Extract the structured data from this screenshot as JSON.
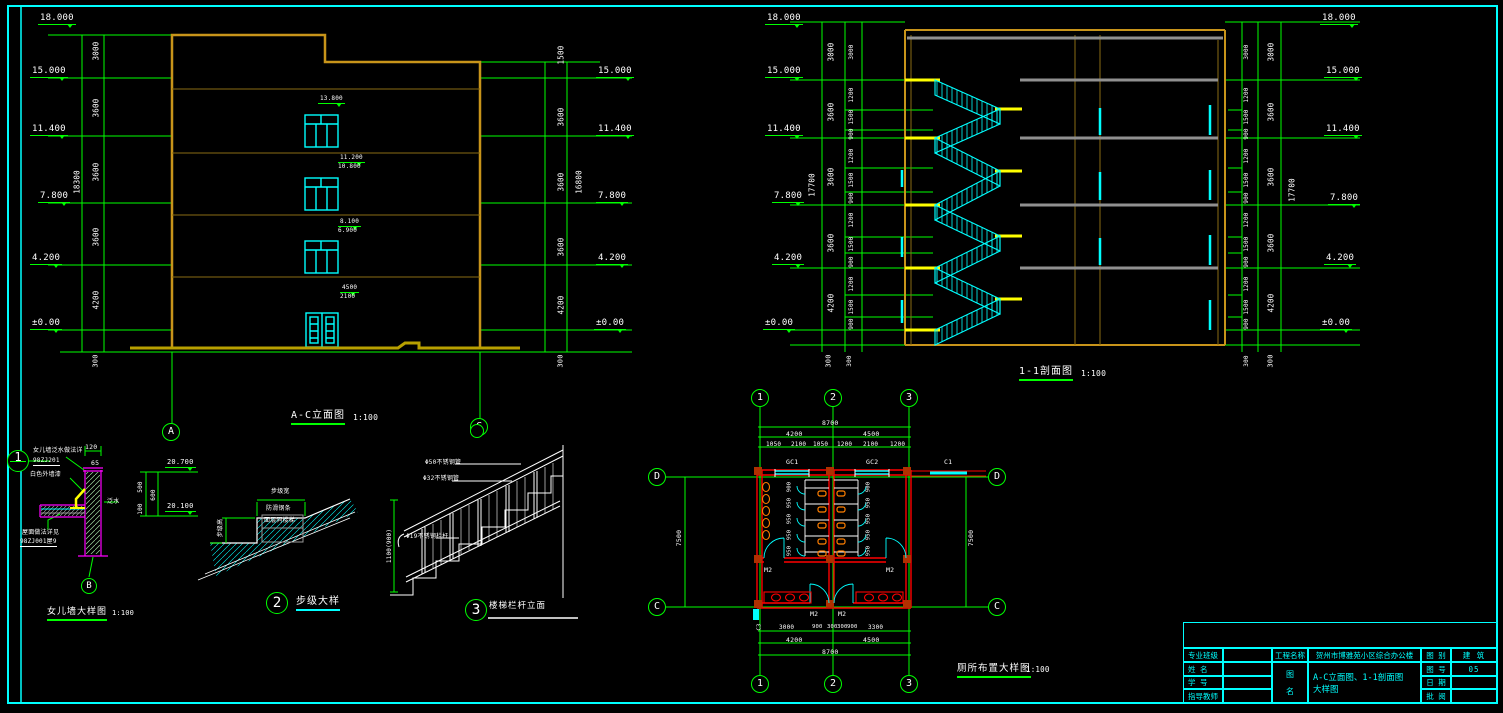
{
  "sheet": {
    "background": "#000000",
    "frame_color": "#00ffff"
  },
  "colors": {
    "dim_green": "#00ff00",
    "text_white": "#ffffff",
    "window_cyan": "#00ffff",
    "wall_orange": "#c8941a",
    "floor_brown": "#8a6d14",
    "ground_yellow": "#b8a000",
    "landing_yellow": "#ffff00",
    "parapet_magenta": "#ff00ff",
    "plan_wall_red": "#ff0000",
    "fixture_orange": "#ff7f00",
    "slab_gray": "#909090"
  },
  "drawings": {
    "elevation": {
      "title": "A-C立面图",
      "scale": "1:100",
      "x": 291,
      "y": 411,
      "u": "g",
      "fs": 10,
      "sx": 353,
      "sy": 414
    },
    "section": {
      "title": "1-1剖面图",
      "scale": "1:100",
      "x": 1019,
      "y": 367,
      "u": "g",
      "fs": 10,
      "sx": 1081,
      "sy": 370
    },
    "parapet": {
      "title": "女儿墙大样图",
      "scale": "1:100",
      "x": 47,
      "y": 608,
      "u": "g",
      "fs": 9,
      "sx": 112,
      "sy": 610
    },
    "step": {
      "title": "步级大样",
      "scale": "",
      "x": 296,
      "y": 597,
      "u": "c",
      "fs": 10,
      "sx": 0,
      "sy": 0
    },
    "railing": {
      "title": "楼梯栏杆立面",
      "scale": "",
      "x": 489,
      "y": 602,
      "u": "",
      "fs": 8.5,
      "sx": 0,
      "sy": 0
    },
    "toilet": {
      "title": "厕所布置大样图",
      "scale": "1:100",
      "x": 957,
      "y": 664,
      "u": "g",
      "fs": 9.5,
      "sx": 1026,
      "sy": 666
    }
  },
  "title_block": {
    "col_left": [
      {
        "label": "专业班级",
        "value": ""
      },
      {
        "label": "姓  名",
        "value": ""
      },
      {
        "label": "学  号",
        "value": ""
      },
      {
        "label": "指导教师",
        "value": ""
      }
    ],
    "project": {
      "label": "工程名称",
      "value": "贺州市博雅苑小区综合办公楼"
    },
    "drawing": {
      "label1": "图",
      "label2": "名",
      "line1": "A-C立面图、1-1剖面图",
      "line2": "大样图"
    },
    "col_right": [
      {
        "label": "图 别",
        "value": "建 筑"
      },
      {
        "label": "图 号",
        "value": "05"
      },
      {
        "label": "日 期",
        "value": ""
      },
      {
        "label": "批 阅",
        "value": ""
      }
    ]
  },
  "axis_bubbles": [
    {
      "t": "A",
      "x": 171,
      "y": 432,
      "r": 9
    },
    {
      "t": "C",
      "x": 479,
      "y": 427,
      "r": 9
    },
    {
      "t": "1",
      "x": 760,
      "y": 398,
      "r": 9
    },
    {
      "t": "2",
      "x": 833,
      "y": 398,
      "r": 9
    },
    {
      "t": "3",
      "x": 909,
      "y": 398,
      "r": 9
    },
    {
      "t": "1",
      "x": 760,
      "y": 684,
      "r": 9
    },
    {
      "t": "2",
      "x": 833,
      "y": 684,
      "r": 9
    },
    {
      "t": "3",
      "x": 909,
      "y": 684,
      "r": 9
    },
    {
      "t": "D",
      "x": 657,
      "y": 477,
      "r": 9
    },
    {
      "t": "D",
      "x": 997,
      "y": 477,
      "r": 9
    },
    {
      "t": "C",
      "x": 657,
      "y": 607,
      "r": 9
    },
    {
      "t": "C",
      "x": 997,
      "y": 607,
      "r": 9
    },
    {
      "t": "B",
      "x": 89,
      "y": 586,
      "r": 8
    },
    {
      "t": "1",
      "x": 18,
      "y": 461,
      "r": 11,
      "split": 1
    },
    {
      "t": "2",
      "x": 277,
      "y": 603,
      "r": 11,
      "d": 1
    },
    {
      "t": "3",
      "x": 476,
      "y": 610,
      "r": 11,
      "d": 1
    },
    {
      "t": "",
      "x": 477,
      "y": 431,
      "r": 7
    }
  ],
  "labels": [
    {
      "t": "18.000",
      "x": 38,
      "y": 14,
      "lvl": 1,
      "fs": 9
    },
    {
      "t": "15.000",
      "x": 30,
      "y": 67,
      "lvl": 1,
      "fs": 9
    },
    {
      "t": "11.400",
      "x": 30,
      "y": 125,
      "lvl": 1,
      "fs": 9
    },
    {
      "t": "7.800",
      "x": 38,
      "y": 192,
      "lvl": 1,
      "fs": 9
    },
    {
      "t": "4.200",
      "x": 30,
      "y": 254,
      "lvl": 1,
      "fs": 9
    },
    {
      "t": "±0.00",
      "x": 30,
      "y": 319,
      "lvl": 1,
      "fs": 9
    },
    {
      "t": "3000",
      "x": 96,
      "y": 51,
      "r": 1
    },
    {
      "t": "3600",
      "x": 96,
      "y": 108,
      "r": 1
    },
    {
      "t": "3600",
      "x": 96,
      "y": 172,
      "r": 1
    },
    {
      "t": "18300",
      "x": 77,
      "y": 182,
      "r": 1
    },
    {
      "t": "3600",
      "x": 96,
      "y": 237,
      "r": 1
    },
    {
      "t": "4200",
      "x": 96,
      "y": 300,
      "r": 1
    },
    {
      "t": "300",
      "x": 96,
      "y": 361,
      "r": 1,
      "fs": 7
    },
    {
      "t": "1500",
      "x": 561,
      "y": 55,
      "r": 1
    },
    {
      "t": "15.000",
      "x": 596,
      "y": 67,
      "lvl": 1,
      "fs": 9
    },
    {
      "t": "3600",
      "x": 561,
      "y": 117,
      "r": 1
    },
    {
      "t": "11.400",
      "x": 596,
      "y": 125,
      "lvl": 1,
      "fs": 9
    },
    {
      "t": "3600",
      "x": 561,
      "y": 182,
      "r": 1
    },
    {
      "t": "16800",
      "x": 579,
      "y": 182,
      "r": 1
    },
    {
      "t": "7.800",
      "x": 596,
      "y": 192,
      "lvl": 1,
      "fs": 9
    },
    {
      "t": "3600",
      "x": 561,
      "y": 247,
      "r": 1
    },
    {
      "t": "4.200",
      "x": 596,
      "y": 254,
      "lvl": 1,
      "fs": 9
    },
    {
      "t": "4200",
      "x": 561,
      "y": 305,
      "r": 1
    },
    {
      "t": "±0.00",
      "x": 594,
      "y": 319,
      "lvl": 1,
      "fs": 9
    },
    {
      "t": "300",
      "x": 561,
      "y": 361,
      "r": 1,
      "fs": 7
    },
    {
      "t": "13.800",
      "x": 318,
      "y": 96,
      "lvl": 1,
      "fs": 6
    },
    {
      "t": "11.200",
      "x": 338,
      "y": 155,
      "lvl": 1,
      "fs": 6
    },
    {
      "t": "10.800",
      "x": 338,
      "y": 164,
      "fs": 6
    },
    {
      "t": "8.100",
      "x": 338,
      "y": 219,
      "lvl": 1,
      "fs": 6
    },
    {
      "t": "6.900",
      "x": 338,
      "y": 228,
      "fs": 6
    },
    {
      "t": "4500",
      "x": 340,
      "y": 285,
      "lvl": 1,
      "fs": 6
    },
    {
      "t": "2100",
      "x": 340,
      "y": 294,
      "fs": 6
    },
    {
      "t": "18.000",
      "x": 765,
      "y": 14,
      "lvl": 1,
      "fs": 9
    },
    {
      "t": "15.000",
      "x": 765,
      "y": 67,
      "lvl": 1,
      "fs": 9
    },
    {
      "t": "11.400",
      "x": 765,
      "y": 125,
      "lvl": 1,
      "fs": 9
    },
    {
      "t": "7.800",
      "x": 772,
      "y": 192,
      "lvl": 1,
      "fs": 9
    },
    {
      "t": "4.200",
      "x": 772,
      "y": 254,
      "lvl": 1,
      "fs": 9
    },
    {
      "t": "±0.00",
      "x": 763,
      "y": 319,
      "lvl": 1,
      "fs": 9
    },
    {
      "t": "3000",
      "x": 831,
      "y": 52,
      "r": 1
    },
    {
      "t": "3600",
      "x": 831,
      "y": 112,
      "r": 1
    },
    {
      "t": "3600",
      "x": 831,
      "y": 177,
      "r": 1
    },
    {
      "t": "17700",
      "x": 812,
      "y": 185,
      "r": 1
    },
    {
      "t": "3600",
      "x": 831,
      "y": 243,
      "r": 1
    },
    {
      "t": "4200",
      "x": 831,
      "y": 303,
      "r": 1
    },
    {
      "t": "300",
      "x": 829,
      "y": 361,
      "r": 1,
      "fs": 7
    },
    {
      "t": "3000",
      "x": 852,
      "y": 52,
      "r": 1,
      "fs": 6
    },
    {
      "t": "1200",
      "x": 852,
      "y": 95,
      "r": 1,
      "fs": 6
    },
    {
      "t": "1500",
      "x": 852,
      "y": 117,
      "r": 1,
      "fs": 6
    },
    {
      "t": "900",
      "x": 852,
      "y": 134,
      "r": 1,
      "fs": 6
    },
    {
      "t": "1200",
      "x": 852,
      "y": 156,
      "r": 1,
      "fs": 6
    },
    {
      "t": "1500",
      "x": 852,
      "y": 180,
      "r": 1,
      "fs": 6
    },
    {
      "t": "900",
      "x": 852,
      "y": 198,
      "r": 1,
      "fs": 6
    },
    {
      "t": "1200",
      "x": 852,
      "y": 220,
      "r": 1,
      "fs": 6
    },
    {
      "t": "1500",
      "x": 852,
      "y": 244,
      "r": 1,
      "fs": 6
    },
    {
      "t": "900",
      "x": 852,
      "y": 262,
      "r": 1,
      "fs": 6
    },
    {
      "t": "1200",
      "x": 852,
      "y": 284,
      "r": 1,
      "fs": 6
    },
    {
      "t": "1500",
      "x": 852,
      "y": 307,
      "r": 1,
      "fs": 6
    },
    {
      "t": "900",
      "x": 852,
      "y": 324,
      "r": 1,
      "fs": 6
    },
    {
      "t": "300",
      "x": 850,
      "y": 361,
      "r": 1,
      "fs": 6
    },
    {
      "t": "3000",
      "x": 1247,
      "y": 52,
      "r": 1,
      "fs": 6
    },
    {
      "t": "1200",
      "x": 1247,
      "y": 95,
      "r": 1,
      "fs": 6
    },
    {
      "t": "1500",
      "x": 1247,
      "y": 117,
      "r": 1,
      "fs": 6
    },
    {
      "t": "900",
      "x": 1247,
      "y": 134,
      "r": 1,
      "fs": 6
    },
    {
      "t": "1200",
      "x": 1247,
      "y": 156,
      "r": 1,
      "fs": 6
    },
    {
      "t": "1500",
      "x": 1247,
      "y": 180,
      "r": 1,
      "fs": 6
    },
    {
      "t": "900",
      "x": 1247,
      "y": 198,
      "r": 1,
      "fs": 6
    },
    {
      "t": "1200",
      "x": 1247,
      "y": 220,
      "r": 1,
      "fs": 6
    },
    {
      "t": "1500",
      "x": 1247,
      "y": 244,
      "r": 1,
      "fs": 6
    },
    {
      "t": "900",
      "x": 1247,
      "y": 262,
      "r": 1,
      "fs": 6
    },
    {
      "t": "1200",
      "x": 1247,
      "y": 284,
      "r": 1,
      "fs": 6
    },
    {
      "t": "1500",
      "x": 1247,
      "y": 307,
      "r": 1,
      "fs": 6
    },
    {
      "t": "900",
      "x": 1247,
      "y": 324,
      "r": 1,
      "fs": 6
    },
    {
      "t": "300",
      "x": 1247,
      "y": 361,
      "r": 1,
      "fs": 6
    },
    {
      "t": "3000",
      "x": 1271,
      "y": 52,
      "r": 1
    },
    {
      "t": "3600",
      "x": 1271,
      "y": 112,
      "r": 1
    },
    {
      "t": "3600",
      "x": 1271,
      "y": 177,
      "r": 1
    },
    {
      "t": "17700",
      "x": 1292,
      "y": 190,
      "r": 1
    },
    {
      "t": "3600",
      "x": 1271,
      "y": 243,
      "r": 1
    },
    {
      "t": "4200",
      "x": 1271,
      "y": 303,
      "r": 1
    },
    {
      "t": "300",
      "x": 1271,
      "y": 361,
      "r": 1,
      "fs": 7
    },
    {
      "t": "18.000",
      "x": 1320,
      "y": 14,
      "lvl": 1,
      "fs": 9
    },
    {
      "t": "15.000",
      "x": 1324,
      "y": 67,
      "lvl": 1,
      "fs": 9
    },
    {
      "t": "11.400",
      "x": 1324,
      "y": 125,
      "lvl": 1,
      "fs": 9
    },
    {
      "t": "7.800",
      "x": 1328,
      "y": 194,
      "lvl": 1,
      "fs": 9
    },
    {
      "t": "4.200",
      "x": 1324,
      "y": 254,
      "lvl": 1,
      "fs": 9
    },
    {
      "t": "±0.00",
      "x": 1320,
      "y": 319,
      "lvl": 1,
      "fs": 9
    },
    {
      "t": "女儿墙泛水做法详",
      "x": 33,
      "y": 448,
      "fs": 6
    },
    {
      "t": "98ZJ201",
      "x": 33,
      "y": 458,
      "fs": 6,
      "u": "w"
    },
    {
      "t": "白色外墙漆",
      "x": 30,
      "y": 472,
      "fs": 6
    },
    {
      "t": "120",
      "x": 85,
      "y": 444,
      "fs": 6.5
    },
    {
      "t": "65",
      "x": 91,
      "y": 460,
      "fs": 6.5
    },
    {
      "t": "20.700",
      "x": 165,
      "y": 459,
      "lvl": 1,
      "fs": 7
    },
    {
      "t": "20.100",
      "x": 165,
      "y": 503,
      "lvl": 1,
      "fs": 7
    },
    {
      "t": "500",
      "x": 141,
      "y": 487,
      "r": 1,
      "fs": 6
    },
    {
      "t": "100",
      "x": 141,
      "y": 509,
      "r": 1,
      "fs": 6
    },
    {
      "t": "600",
      "x": 154,
      "y": 495,
      "r": 1,
      "fs": 6
    },
    {
      "t": "泛水",
      "x": 107,
      "y": 499,
      "fs": 6
    },
    {
      "t": "屋面做法详见",
      "x": 22,
      "y": 530,
      "fs": 6
    },
    {
      "t": "98ZJ001屋9",
      "x": 20,
      "y": 539,
      "fs": 6,
      "u": "w"
    },
    {
      "t": "步级宽",
      "x": 271,
      "y": 489,
      "fs": 6
    },
    {
      "t": "防滑钢条",
      "x": 266,
      "y": 506,
      "fs": 6
    },
    {
      "t": "面层同楼梯",
      "x": 264,
      "y": 518,
      "fs": 6
    },
    {
      "t": "步级高",
      "x": 221,
      "y": 528,
      "r": 1,
      "fs": 6
    },
    {
      "t": "Φ50不锈钢管",
      "x": 425,
      "y": 460,
      "fs": 6
    },
    {
      "t": "Φ32不锈钢管",
      "x": 423,
      "y": 476,
      "fs": 6
    },
    {
      "t": "Φ19不锈钢栏杆",
      "x": 406,
      "y": 534,
      "fs": 6
    },
    {
      "t": "1100(900)",
      "x": 390,
      "y": 546,
      "r": 1,
      "fs": 6
    },
    {
      "t": "8700",
      "x": 822,
      "y": 420,
      "fs": 6.5
    },
    {
      "t": "4200",
      "x": 786,
      "y": 431,
      "fs": 6.5
    },
    {
      "t": "4500",
      "x": 863,
      "y": 431,
      "fs": 6.5
    },
    {
      "t": "1050",
      "x": 766,
      "y": 442,
      "fs": 6
    },
    {
      "t": "2100",
      "x": 791,
      "y": 442,
      "fs": 6
    },
    {
      "t": "1050",
      "x": 813,
      "y": 442,
      "fs": 6
    },
    {
      "t": "1200",
      "x": 837,
      "y": 442,
      "fs": 6
    },
    {
      "t": "2100",
      "x": 863,
      "y": 442,
      "fs": 6
    },
    {
      "t": "1200",
      "x": 890,
      "y": 442,
      "fs": 6
    },
    {
      "t": "GC1",
      "x": 786,
      "y": 459,
      "fs": 6.5
    },
    {
      "t": "GC2",
      "x": 866,
      "y": 459,
      "fs": 6.5
    },
    {
      "t": "C1",
      "x": 944,
      "y": 459,
      "fs": 6.5
    },
    {
      "t": "7500",
      "x": 679,
      "y": 538,
      "r": 1,
      "fs": 6.5
    },
    {
      "t": "7500",
      "x": 971,
      "y": 538,
      "r": 1,
      "fs": 6.5
    },
    {
      "t": "900",
      "x": 790,
      "y": 487,
      "r": 1,
      "fs": 5.5
    },
    {
      "t": "950",
      "x": 790,
      "y": 503,
      "r": 1,
      "fs": 5.5
    },
    {
      "t": "950",
      "x": 790,
      "y": 519,
      "r": 1,
      "fs": 5.5
    },
    {
      "t": "950",
      "x": 790,
      "y": 535,
      "r": 1,
      "fs": 5.5
    },
    {
      "t": "950",
      "x": 790,
      "y": 551,
      "r": 1,
      "fs": 5.5
    },
    {
      "t": "900",
      "x": 869,
      "y": 487,
      "r": 1,
      "fs": 5.5
    },
    {
      "t": "950",
      "x": 869,
      "y": 503,
      "r": 1,
      "fs": 5.5
    },
    {
      "t": "950",
      "x": 869,
      "y": 519,
      "r": 1,
      "fs": 5.5
    },
    {
      "t": "950",
      "x": 869,
      "y": 535,
      "r": 1,
      "fs": 5.5
    },
    {
      "t": "950",
      "x": 869,
      "y": 551,
      "r": 1,
      "fs": 5.5
    },
    {
      "t": "M2",
      "x": 764,
      "y": 567,
      "fs": 6.5
    },
    {
      "t": "M2",
      "x": 886,
      "y": 567,
      "fs": 6.5
    },
    {
      "t": "M2",
      "x": 810,
      "y": 611,
      "fs": 6.5
    },
    {
      "t": "M2",
      "x": 838,
      "y": 611,
      "fs": 6.5
    },
    {
      "t": "C3",
      "x": 760,
      "y": 627,
      "r": 1,
      "fs": 5.5
    },
    {
      "t": "3000",
      "x": 779,
      "y": 625,
      "fs": 6
    },
    {
      "t": "900",
      "x": 812,
      "y": 625,
      "fs": 5.5
    },
    {
      "t": "300",
      "x": 827,
      "y": 625,
      "fs": 5.5
    },
    {
      "t": "300",
      "x": 837,
      "y": 625,
      "fs": 5.5
    },
    {
      "t": "900",
      "x": 847,
      "y": 625,
      "fs": 5.5
    },
    {
      "t": "3300",
      "x": 868,
      "y": 625,
      "fs": 6
    },
    {
      "t": "4200",
      "x": 786,
      "y": 637,
      "fs": 6.5
    },
    {
      "t": "4500",
      "x": 863,
      "y": 637,
      "fs": 6.5
    },
    {
      "t": "8700",
      "x": 822,
      "y": 649,
      "fs": 6.5
    }
  ]
}
